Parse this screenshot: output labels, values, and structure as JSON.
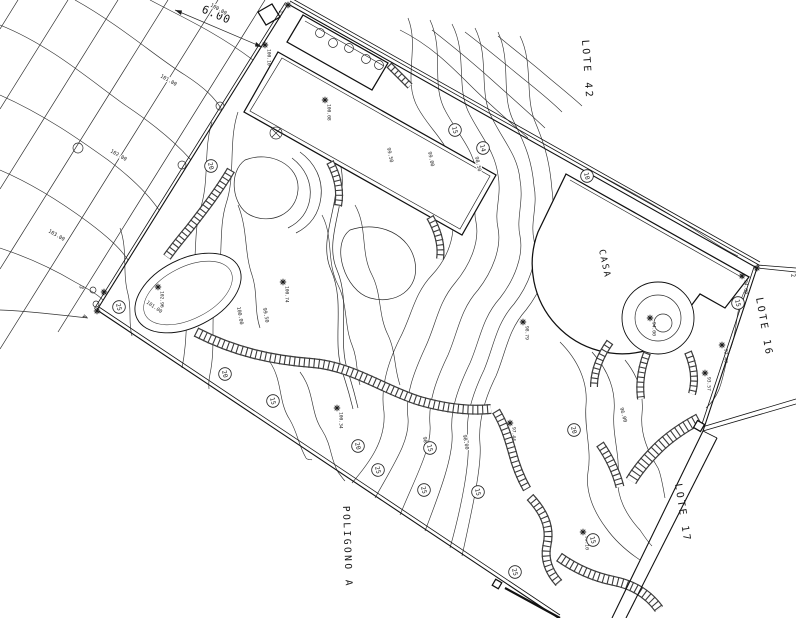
{
  "drawing": {
    "area_labels": {
      "lote42": "LOTE 42",
      "lote16": "LOTE 16",
      "lote17": "LOTE 17",
      "poligono_a": "POLIGONO A",
      "casa": "CASA"
    },
    "dimension_label": "6.00",
    "corner_labels": [
      {
        "v": "1",
        "x": 279,
        "y": 10,
        "r": 90,
        "mx": 288,
        "my": 5
      },
      {
        "v": "2",
        "x": 791,
        "y": 274,
        "r": 80,
        "mx": 757,
        "my": 268
      },
      {
        "v": "3",
        "x": 80,
        "y": 285,
        "r": 100,
        "mx": 104,
        "my": 292
      },
      {
        "v": "4",
        "x": 83,
        "y": 314,
        "r": 100,
        "mx": 97,
        "my": 311
      }
    ],
    "spot_elevations": [
      {
        "x": 325,
        "y": 100,
        "v": "100.08"
      },
      {
        "x": 265,
        "y": 45,
        "v": "100.10"
      },
      {
        "x": 158,
        "y": 287,
        "v": "102.96"
      },
      {
        "x": 283,
        "y": 282,
        "v": "100.74"
      },
      {
        "x": 337,
        "y": 408,
        "v": "100.34"
      },
      {
        "x": 523,
        "y": 322,
        "v": "98.79"
      },
      {
        "x": 650,
        "y": 318,
        "v": "94.00"
      },
      {
        "x": 742,
        "y": 276,
        "v": "94.00"
      },
      {
        "x": 722,
        "y": 345,
        "v": "92.40"
      },
      {
        "x": 705,
        "y": 373,
        "v": "93.57"
      },
      {
        "x": 583,
        "y": 532,
        "v": "95.10"
      },
      {
        "x": 510,
        "y": 423,
        "v": "97.44"
      }
    ],
    "contour_labels": [
      {
        "x": 210,
        "y": 6,
        "v": "100.00",
        "r": 30
      },
      {
        "x": 160,
        "y": 77,
        "v": "101.00",
        "r": 30
      },
      {
        "x": 110,
        "y": 152,
        "v": "102.00",
        "r": 30
      },
      {
        "x": 48,
        "y": 232,
        "v": "103.00",
        "r": 30
      },
      {
        "x": 146,
        "y": 303,
        "v": "101.00",
        "r": 35
      },
      {
        "x": 387,
        "y": 148,
        "v": "99.50",
        "r": 78
      },
      {
        "x": 428,
        "y": 152,
        "v": "99.00",
        "r": 78
      },
      {
        "x": 475,
        "y": 157,
        "v": "98.50",
        "r": 78
      },
      {
        "x": 237,
        "y": 307,
        "v": "100.00",
        "r": 80
      },
      {
        "x": 263,
        "y": 308,
        "v": "99.50",
        "r": 80
      },
      {
        "x": 423,
        "y": 437,
        "v": "98.50",
        "r": 80
      },
      {
        "x": 463,
        "y": 435,
        "v": "98.00",
        "r": 80
      },
      {
        "x": 620,
        "y": 408,
        "v": "96.00",
        "r": 75
      }
    ],
    "plant_tags": [
      {
        "x": 358,
        "y": 446,
        "v": "20"
      },
      {
        "x": 378,
        "y": 470,
        "v": "25"
      },
      {
        "x": 424,
        "y": 490,
        "v": "25"
      },
      {
        "x": 478,
        "y": 492,
        "v": "15"
      },
      {
        "x": 515,
        "y": 572,
        "v": "25"
      },
      {
        "x": 211,
        "y": 166,
        "v": "20"
      },
      {
        "x": 119,
        "y": 307,
        "v": "25"
      },
      {
        "x": 225,
        "y": 374,
        "v": "20"
      },
      {
        "x": 273,
        "y": 401,
        "v": "15"
      },
      {
        "x": 430,
        "y": 448,
        "v": "15"
      },
      {
        "x": 593,
        "y": 540,
        "v": "15"
      },
      {
        "x": 574,
        "y": 430,
        "v": "20"
      },
      {
        "x": 738,
        "y": 303,
        "v": "15"
      },
      {
        "x": 587,
        "y": 176,
        "v": "10"
      },
      {
        "x": 455,
        "y": 130,
        "v": "15"
      },
      {
        "x": 483,
        "y": 148,
        "v": "14"
      }
    ],
    "colors": {
      "ink": "#1c1c1c",
      "paper": "#ffffff"
    }
  }
}
